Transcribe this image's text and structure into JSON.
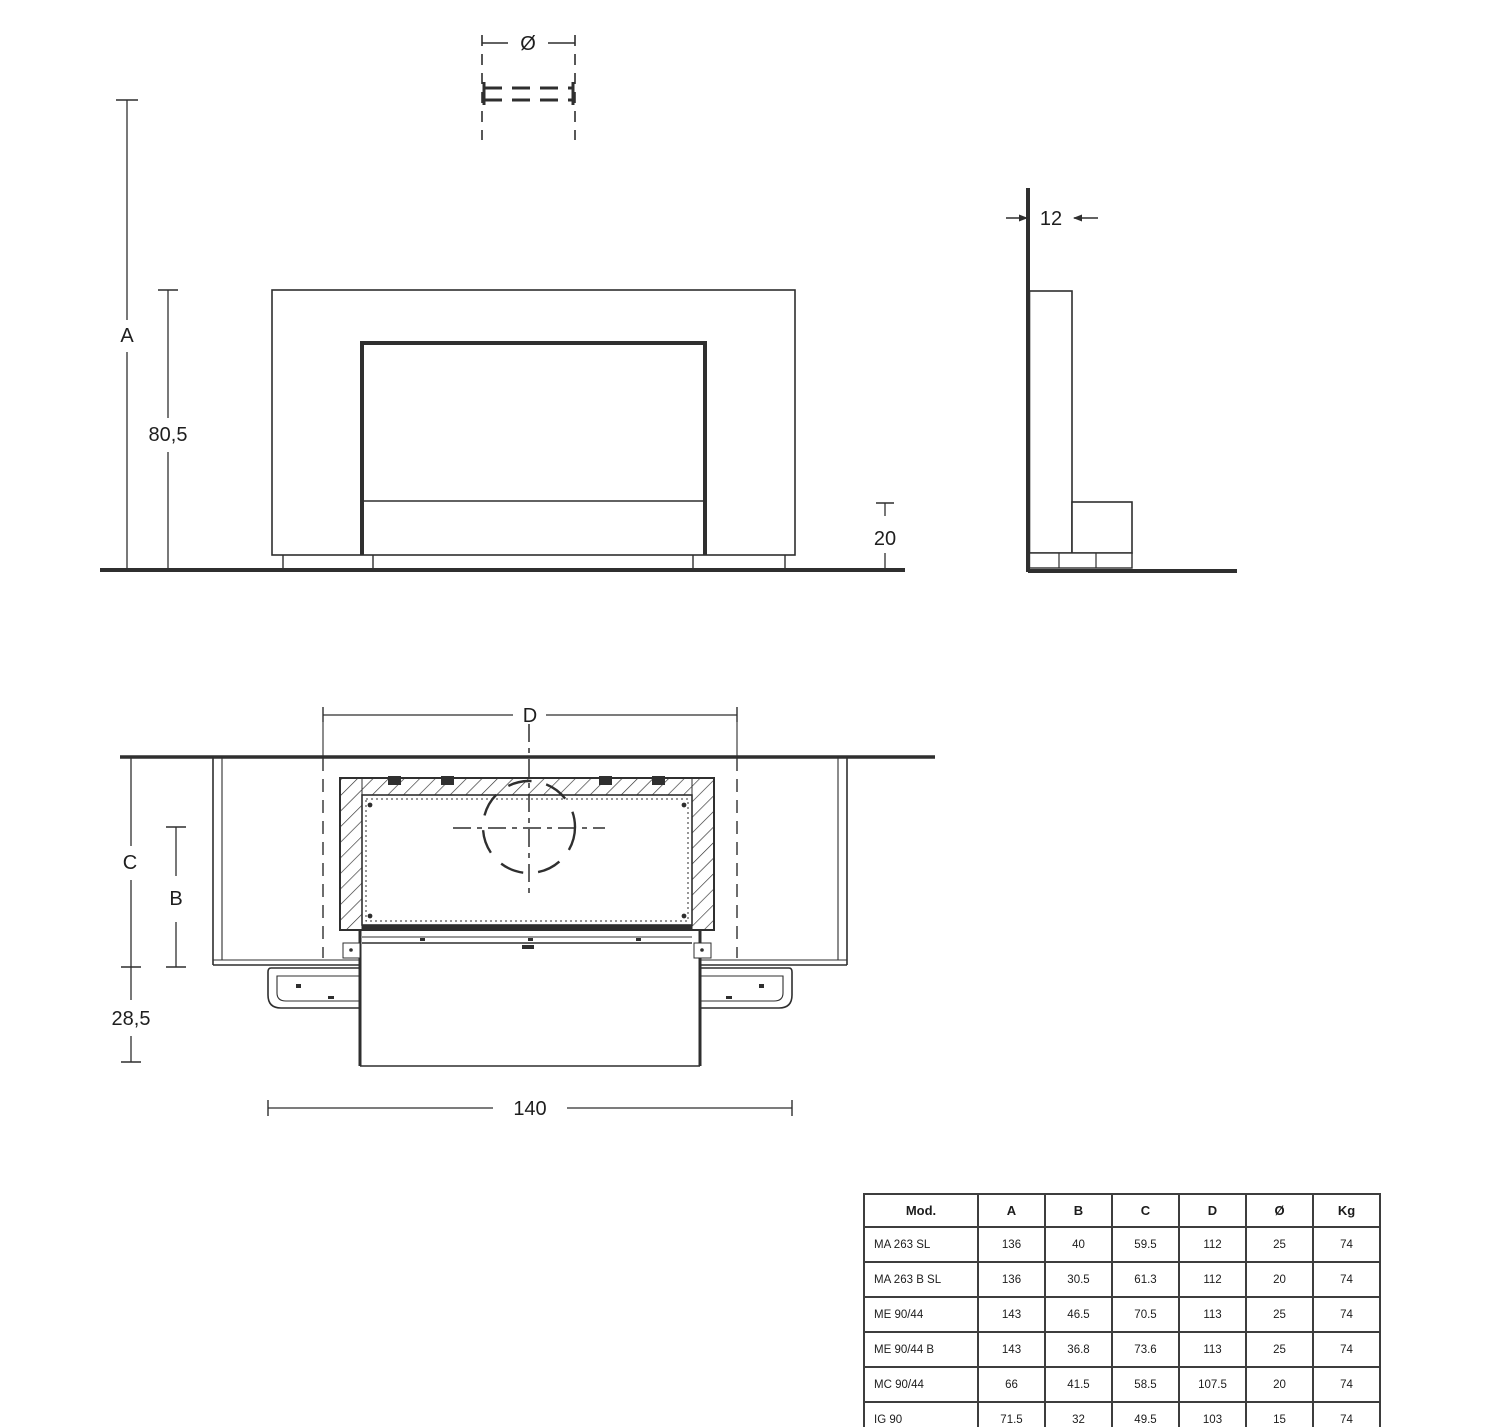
{
  "labels": {
    "flue_diameter": "Ø",
    "total_height": "A",
    "body_height": "80,5",
    "base_height": "20",
    "side_depth": "12",
    "opening_width": "D",
    "total_depth": "C",
    "firebox_depth": "B",
    "hearth_depth": "28,5",
    "total_width": "140"
  },
  "table": {
    "headers": [
      "Mod.",
      "A",
      "B",
      "C",
      "D",
      "Ø",
      "Kg"
    ],
    "rows": [
      [
        "MA 263 SL",
        "136",
        "40",
        "59.5",
        "112",
        "25",
        "74"
      ],
      [
        "MA 263 B SL",
        "136",
        "30.5",
        "61.3",
        "112",
        "20",
        "74"
      ],
      [
        "ME 90/44",
        "143",
        "46.5",
        "70.5",
        "113",
        "25",
        "74"
      ],
      [
        "ME 90/44 B",
        "143",
        "36.8",
        "73.6",
        "113",
        "25",
        "74"
      ],
      [
        "MC 90/44",
        "66",
        "41.5",
        "58.5",
        "107.5",
        "20",
        "74"
      ],
      [
        "IG 90",
        "71.5",
        "32",
        "49.5",
        "103",
        "15",
        "74"
      ]
    ]
  },
  "colors": {
    "line": "#2f2f2f",
    "dim": "#3a3a3a",
    "text": "#1e1e1e"
  }
}
